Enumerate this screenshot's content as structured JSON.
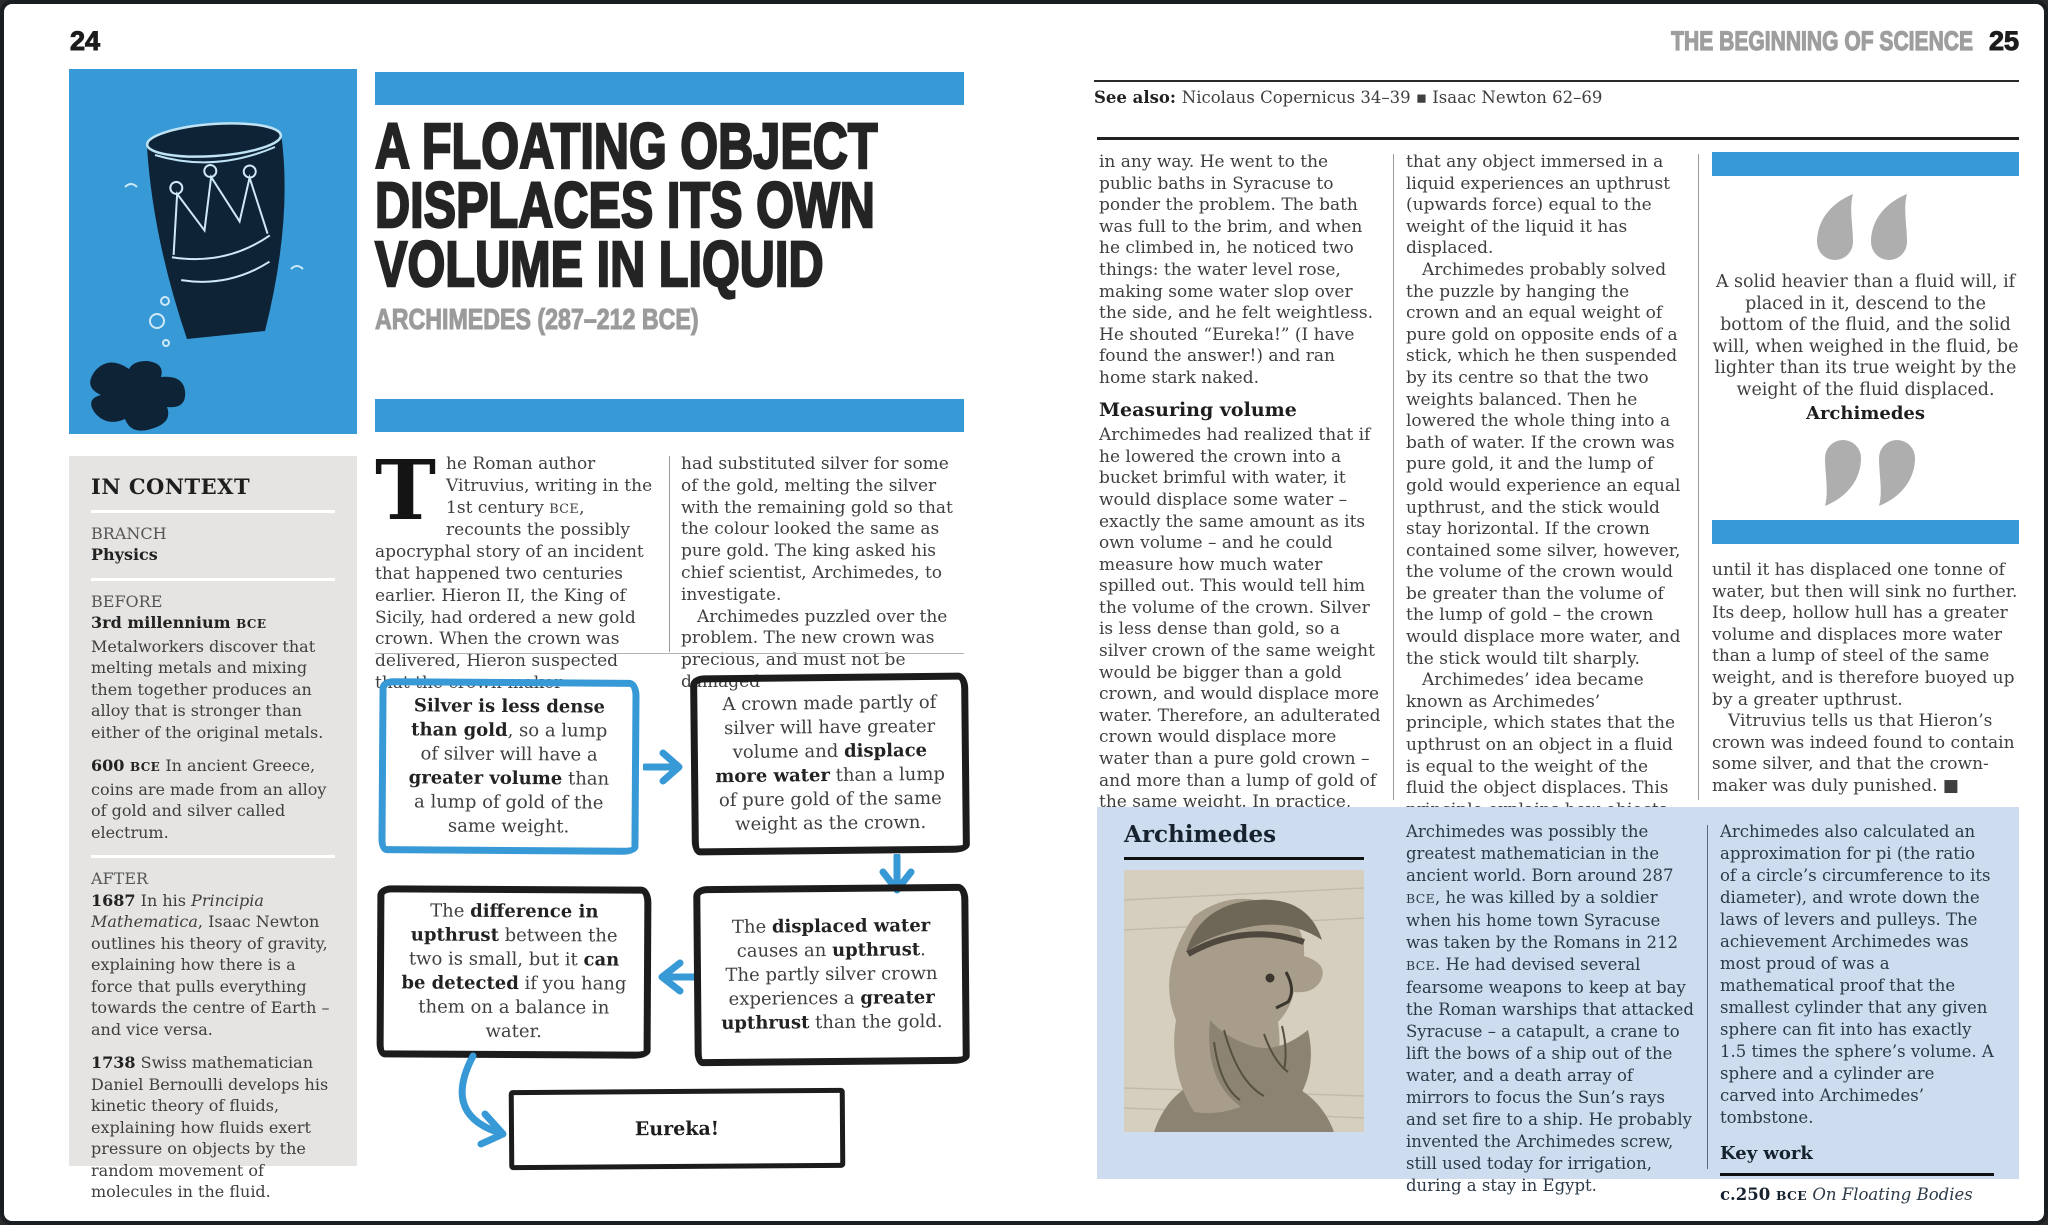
{
  "colors": {
    "accent_blue": "#3799d6",
    "illustration_navy": "#0e2336",
    "sidebar_gray": "#e5e4e2",
    "biography_blue": "#cddcee",
    "running_head_gray": "#9e9e9e"
  },
  "left_page": {
    "page_number": "24",
    "headline_lines": [
      "A FLOATING OBJECT",
      "DISPLACES ITS OWN",
      "VOLUME IN LIQUID"
    ],
    "subtitle": "ARCHIMEDES (287–212 BCE)",
    "in_context": {
      "heading": "IN CONTEXT",
      "branch_label": "BRANCH",
      "branch_value": "Physics",
      "before_label": "BEFORE",
      "before_item_1": [
        {
          "t": "3rd millennium ",
          "b": true
        },
        {
          "t": "BCE",
          "b": true,
          "sc": true
        },
        {
          "t": "\nMetalworkers discover that melting metals and mixing them together produces an alloy that is stronger than either of the original metals."
        }
      ],
      "before_item_2": [
        {
          "t": "600 ",
          "b": true
        },
        {
          "t": "BCE",
          "b": true,
          "sc": true
        },
        {
          "t": " In ancient Greece, coins are made from an alloy of gold and silver called electrum."
        }
      ],
      "after_label": "AFTER",
      "after_item_1": [
        {
          "t": "1687",
          "b": true
        },
        {
          "t": " In his "
        },
        {
          "t": "Principia Mathematica",
          "i": true
        },
        {
          "t": ", Isaac Newton outlines his theory of gravity, explaining how there is a force that pulls everything towards the centre of Earth – and vice versa."
        }
      ],
      "after_item_2": [
        {
          "t": "1738",
          "b": true
        },
        {
          "t": " Swiss mathematician Daniel Bernoulli develops his kinetic theory of fluids, explaining how fluids exert pressure on objects by the random movement of molecules in the fluid."
        }
      ]
    },
    "intro": {
      "dropcap": "T",
      "col1_segments": [
        {
          "t": "he Roman author Vitruvius, writing in the 1st century "
        },
        {
          "t": "BCE",
          "sc": true
        },
        {
          "t": ", recounts the possibly apocryphal story of an incident that happened two centuries earlier. Hieron II, the King of Sicily, had ordered a new gold crown. When the crown was delivered, Hieron suspected that the crown-maker"
        }
      ],
      "col2_para_1": "had substituted silver for some of the gold, melting the silver with the remaining gold so that the colour looked the same as pure gold. The king asked his chief scientist, Archimedes, to investigate.",
      "col2_para_2": "Archimedes puzzled over the problem. The new crown was precious, and must not be damaged"
    },
    "flowchart": {
      "box1_segments": [
        {
          "t": "Silver is less dense than gold",
          "b": true
        },
        {
          "t": ", so a lump of silver will have a "
        },
        {
          "t": "greater volume",
          "b": true
        },
        {
          "t": " than a lump of gold of the same weight."
        }
      ],
      "box2_segments": [
        {
          "t": "A crown made partly of silver will have greater volume and "
        },
        {
          "t": "displace more water",
          "b": true
        },
        {
          "t": " than a lump of pure gold of the same weight as the crown."
        }
      ],
      "box3_segments": [
        {
          "t": "The "
        },
        {
          "t": "difference in upthrust",
          "b": true
        },
        {
          "t": " between the two is small, but it "
        },
        {
          "t": "can be detected",
          "b": true
        },
        {
          "t": " if you hang them on a balance in water."
        }
      ],
      "box4_segments": [
        {
          "t": "The "
        },
        {
          "t": "displaced water",
          "b": true
        },
        {
          "t": " causes an "
        },
        {
          "t": "upthrust",
          "b": true
        },
        {
          "t": ". The partly silver crown experiences a "
        },
        {
          "t": "greater upthrust",
          "b": true
        },
        {
          "t": " than the gold."
        }
      ],
      "eureka_label": "Eureka!"
    }
  },
  "right_page": {
    "header_title": "THE BEGINNING OF SCIENCE",
    "page_number": "25",
    "see_also_segments": [
      {
        "t": "See also: ",
        "b": true
      },
      {
        "t": "Nicolaus Copernicus 34–39  ▪  Isaac Newton 62–69"
      }
    ],
    "col1": {
      "para_1": "in any way. He went to the public baths in Syracuse to ponder the problem. The bath was full to the brim, and when he climbed in, he noticed two things: the water level rose, making some water slop over the side, and he felt weightless. He shouted “Eureka!” (I have found the answer!) and ran home stark naked.",
      "heading": "Measuring volume",
      "para_2": "Archimedes had realized that if he lowered the crown into a bucket brimful with water, it would displace some water – exactly the same amount as its own volume – and he could measure how much water spilled out. This would tell him the volume of the crown. Silver is less dense than gold, so a silver crown of the same weight would be bigger than a gold crown, and would displace more water. Therefore, an adulterated crown would displace more water than a pure gold crown – and more than a lump of gold of the same weight. In practice, the effect would have been small and difficult to measure. But Archimedes had also realized"
    },
    "col2": {
      "para_1": "that any object immersed in a liquid experiences an upthrust (upwards force) equal to the weight of the liquid it has displaced.",
      "para_2": "Archimedes probably solved the puzzle by hanging the crown and an equal weight of pure gold on opposite ends of a stick, which he then suspended by its centre so that the two weights balanced. Then he lowered the whole thing into a bath of water. If the crown was pure gold, it and the lump of gold would experience an equal upthrust, and the stick would stay horizontal. If the crown contained some silver, however, the volume of the crown would be greater than the volume of the lump of gold – the crown would displace more water, and the stick would tilt sharply.",
      "para_3": "Archimedes’ idea became known as Archimedes’ principle, which states that the upthrust on an object in a fluid is equal to the weight of the fluid the object displaces. This principle explains how objects made of dense material can still float on water. A steel ship that weighs one tonne will sink"
    },
    "quote_panel": {
      "quote": "A solid heavier than a fluid will, if placed in it, descend to the bottom of the fluid, and the solid will, when weighed in the fluid, be lighter than its true weight by the weight of the fluid displaced.",
      "attribution": "Archimedes",
      "after_para_1": "until it has displaced one tonne of water, but then will sink no further. Its deep, hollow hull has a greater volume and displaces more water than a lump of steel of the same weight, and is therefore buoyed up by a greater upthrust.",
      "after_para_2": "Vitruvius tells us that Hieron’s crown was indeed found to contain some silver, and that the crown-maker was duly punished. ■"
    },
    "biography": {
      "title": "Archimedes",
      "col1_segments": [
        {
          "t": "Archimedes was possibly the greatest mathematician in the ancient world. Born around 287 "
        },
        {
          "t": "BCE",
          "sc": true
        },
        {
          "t": ", he was killed by a soldier when his home town Syracuse was taken by the Romans in 212 "
        },
        {
          "t": "BCE",
          "sc": true
        },
        {
          "t": ". He had devised several fearsome weapons to keep at bay the Roman warships that attacked Syracuse – a catapult, a crane to lift the bows of a ship out of the water, and a death array of mirrors to focus the Sun’s rays and set fire to a ship. He probably invented the Archimedes screw, still used today for irrigation, during a stay in Egypt."
        }
      ],
      "col2_text": "Archimedes also calculated an approximation for pi (the ratio of a circle’s circumference to its diameter), and wrote down the laws of levers and pulleys. The achievement Archimedes was most proud of was a mathematical proof that the smallest cylinder that any given sphere can fit into has exactly 1.5 times the sphere’s volume. A sphere and a cylinder are carved into Archimedes’ tombstone.",
      "key_work_label": "Key work",
      "key_work_segments": [
        {
          "t": "c.250 ",
          "b": true
        },
        {
          "t": "BCE",
          "b": true,
          "sc": true
        },
        {
          "t": " On Floating Bodies",
          "i": true
        }
      ]
    }
  }
}
